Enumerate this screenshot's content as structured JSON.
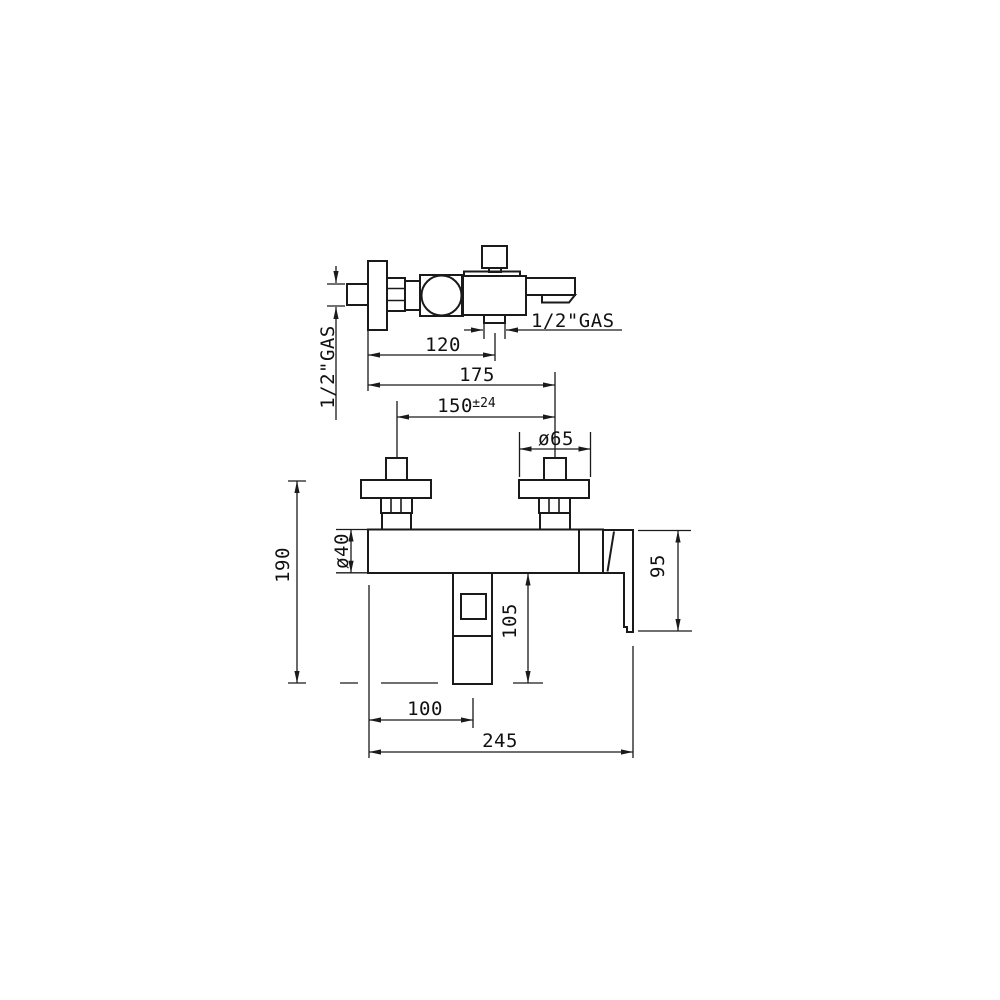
{
  "colors": {
    "line": "#1a1a1a",
    "background": "#ffffff"
  },
  "drawing_type": "faucet installation dimensional drawing",
  "views": {
    "side": {
      "wall_thread_label": "1/2\"GAS",
      "outlet_thread_label": "1/2\"GAS",
      "dims": {
        "wall_to_outlet": "120",
        "wall_to_inlet_center": "175",
        "inlet_centers": "150",
        "inlet_centers_tolerance": "±24",
        "flange_diameter": "ø65"
      }
    },
    "front": {
      "dims": {
        "overall_height": "190",
        "body_diameter": "ø40",
        "handle_drop": "95",
        "outlet_drop": "105",
        "left_to_outlet_center": "100",
        "overall_width": "245"
      }
    }
  }
}
